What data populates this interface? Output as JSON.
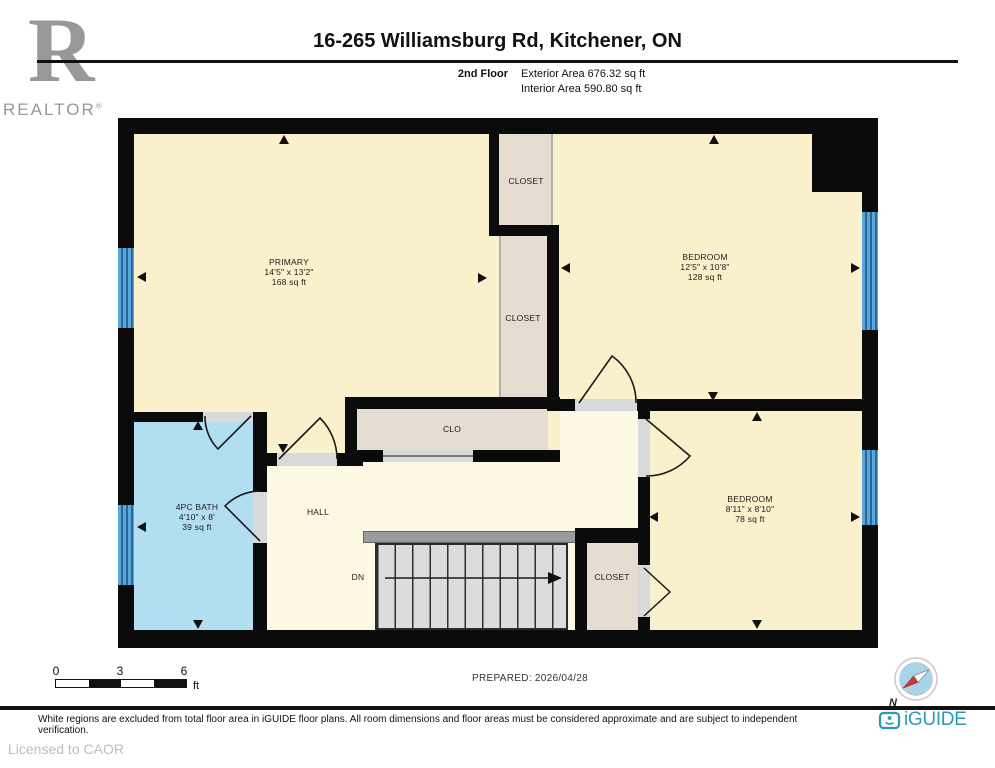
{
  "header": {
    "title": "16-265 Williamsburg Rd, Kitchener, ON",
    "floor_label": "2nd Floor",
    "exterior_area": "Exterior Area 676.32 sq ft",
    "interior_area": "Interior Area 590.80 sq ft"
  },
  "branding": {
    "realtor_logo_letter": "R",
    "realtor_text": "REALTOR",
    "realtor_reg_mark": "®",
    "iguide_text": "iGUIDE",
    "licensed_text": "Licensed to CAOR"
  },
  "rooms": {
    "primary": {
      "name": "PRIMARY",
      "dims": "14'5\" x 13'2\"",
      "area": "168 sq ft"
    },
    "bedroom1": {
      "name": "BEDROOM",
      "dims": "12'5\" x 10'8\"",
      "area": "128 sq ft"
    },
    "bedroom2": {
      "name": "BEDROOM",
      "dims": "8'11\" x 8'10\"",
      "area": "78 sq ft"
    },
    "bath": {
      "name": "4PC BATH",
      "dims": "4'10\" x 8'",
      "area": "39 sq ft"
    },
    "closet_top": {
      "name": "CLOSET"
    },
    "closet_mid": {
      "name": "CLOSET"
    },
    "clo": {
      "name": "CLO"
    },
    "hall": {
      "name": "HALL"
    },
    "closet_stairs": {
      "name": "CLOSET"
    },
    "stairs": {
      "label": "DN"
    }
  },
  "legend": {
    "scale_ticks": [
      "0",
      "3",
      "6"
    ],
    "scale_unit": "ft",
    "prepared": "PREPARED: 2026/04/28",
    "north": "N"
  },
  "footer": {
    "disclaimer": "White regions are excluded from total floor area in iGUIDE floor plans. All room dimensions and floor areas must be considered approximate and are subject to independent verification."
  },
  "colors": {
    "wall": "#0b0b0b",
    "room": "#FAF0CB",
    "hall": "#FDF8E4",
    "closet": "#E4DDD0",
    "bath": "#B2DEF2",
    "window": "#5BA8D8",
    "window_stripe": "#27679F",
    "stair": "#DCDCDC",
    "stair_rail": "#9B9B9B",
    "door_gap": "#D9D9D9",
    "iguide": "#2B9AB8",
    "logo_gray": "#98989B",
    "compass_fill": "#A8D3E9",
    "compass_needle": "#C8392E"
  }
}
